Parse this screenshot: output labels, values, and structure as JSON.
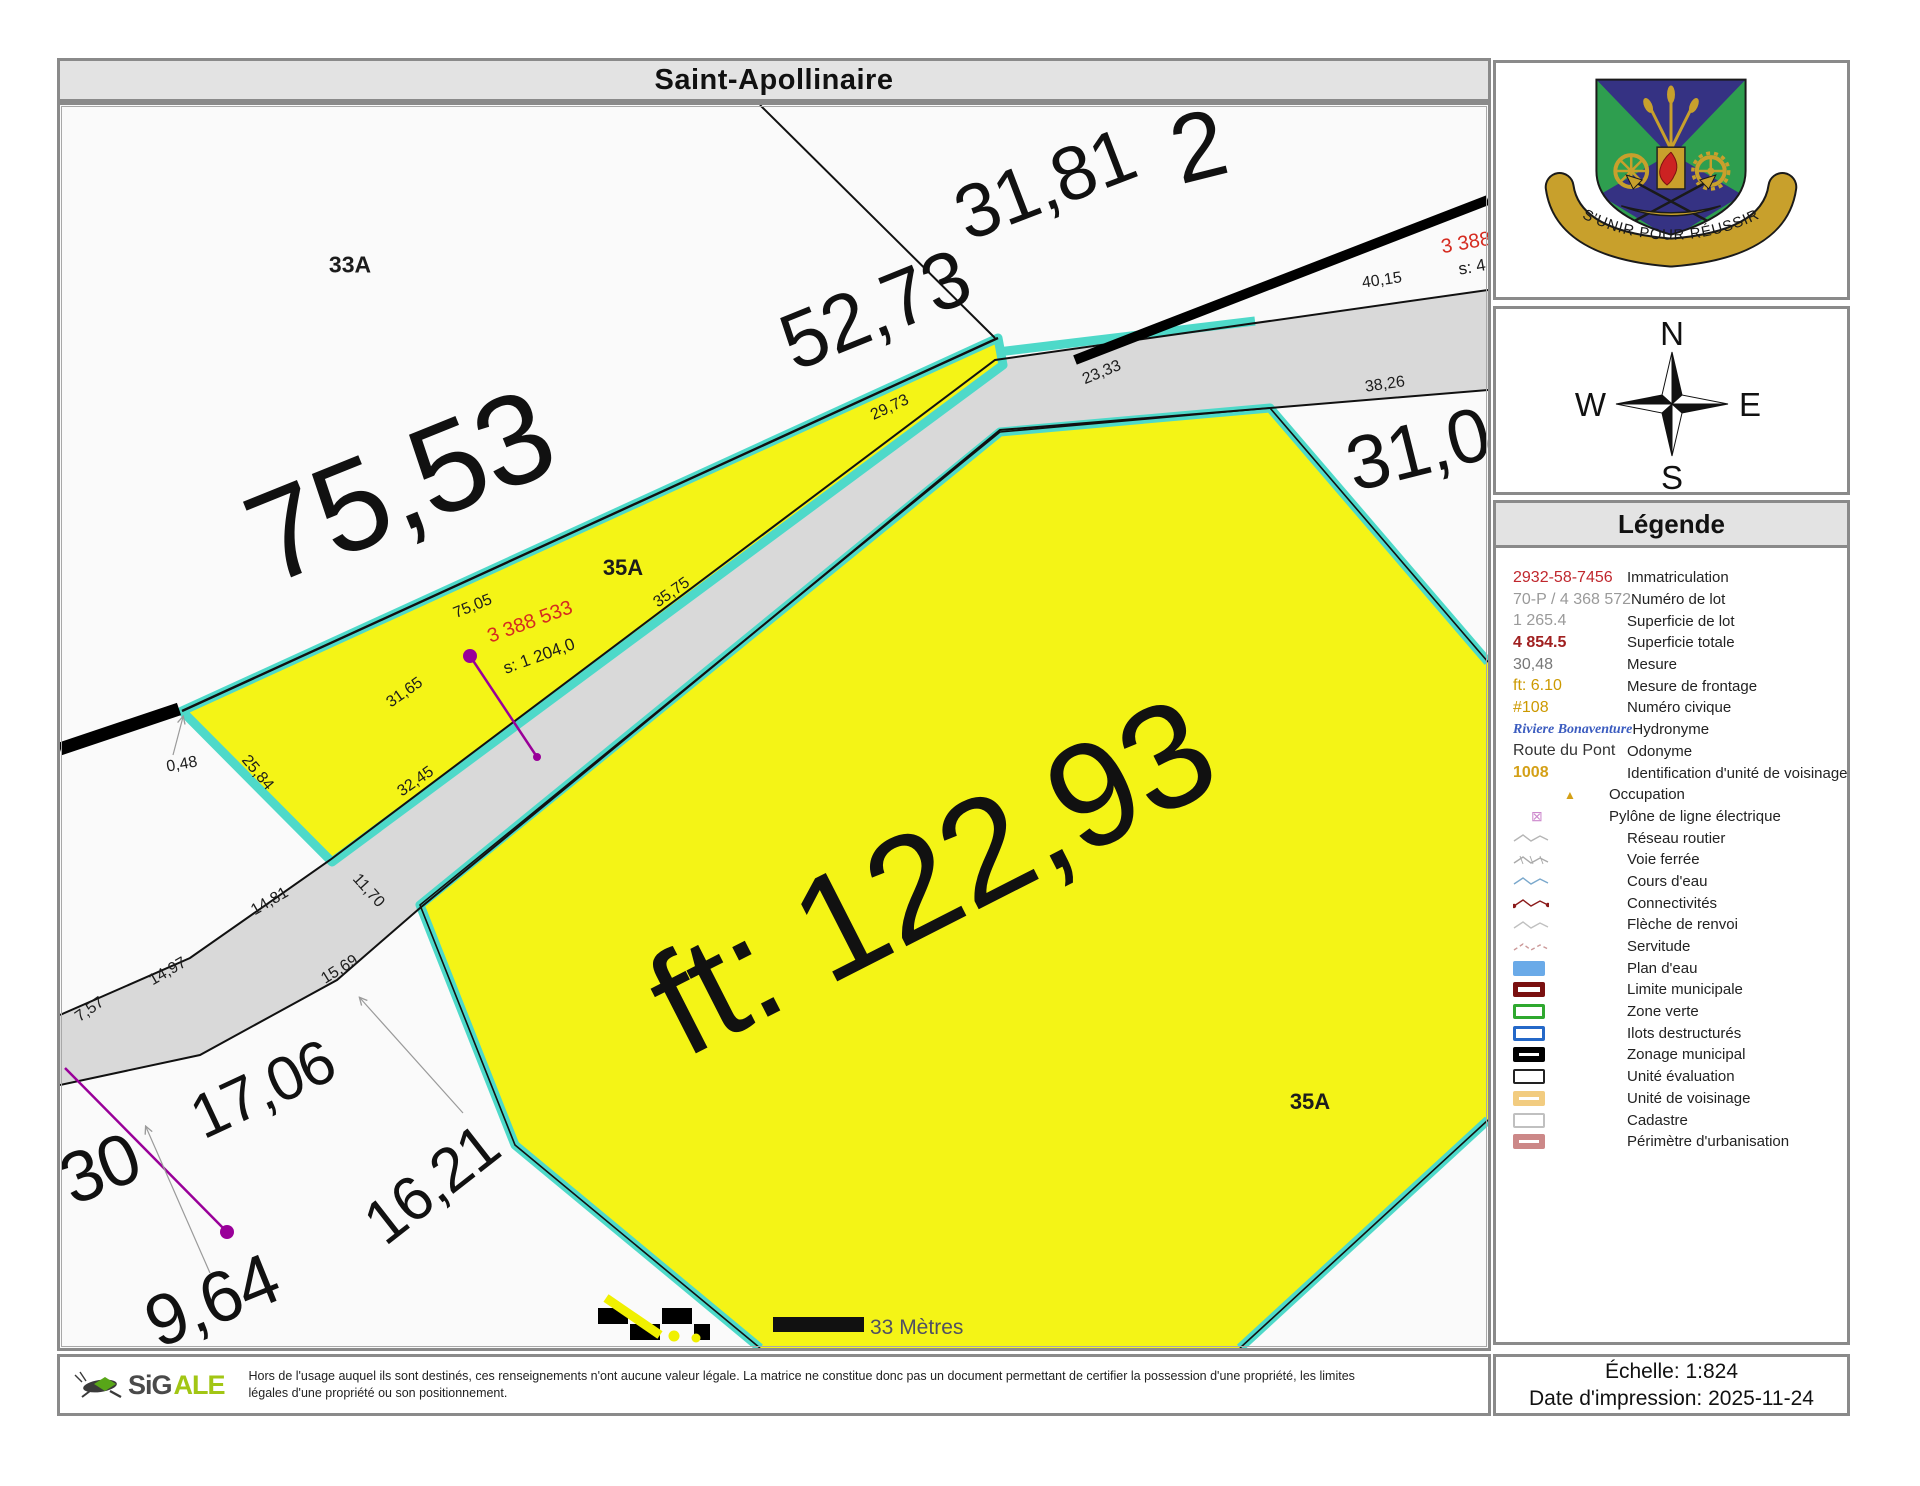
{
  "title": "Saint-Apollinaire",
  "colors": {
    "parcel_yellow": "#f4f416",
    "water_cyan": "#4ed9c9",
    "road_gray": "#d9d9d9",
    "map_bg": "#fafafa",
    "panel_border": "#8a8a8a",
    "header_bg": "#e3e3e3",
    "label_red": "#d52b20",
    "purple": "#990099"
  },
  "map": {
    "scale_bar_label": "33 Mètres",
    "labels": [
      {
        "text": "75,53",
        "x": 340,
        "y": 382,
        "rot": -22,
        "size": 128
      },
      {
        "text": "52,73",
        "x": 815,
        "y": 205,
        "rot": -22,
        "size": 80
      },
      {
        "text": "31,81",
        "x": 985,
        "y": 80,
        "rot": -21,
        "size": 76
      },
      {
        "text": "2",
        "x": 1138,
        "y": 42,
        "rot": -14,
        "size": 96
      },
      {
        "text": "31,0",
        "x": 1358,
        "y": 345,
        "rot": -14,
        "size": 76
      },
      {
        "text": "ft: 122,93",
        "x": 872,
        "y": 772,
        "rot": -27,
        "size": 148
      },
      {
        "text": "17,06",
        "x": 203,
        "y": 985,
        "rot": -25,
        "size": 62
      },
      {
        "text": "16,21",
        "x": 372,
        "y": 1080,
        "rot": -38,
        "size": 62
      },
      {
        "text": "9,64",
        "x": 152,
        "y": 1196,
        "rot": -22,
        "size": 72
      },
      {
        "text": "30",
        "x": 40,
        "y": 1064,
        "rot": -22,
        "size": 72
      },
      {
        "text": "33A",
        "x": 290,
        "y": 160,
        "rot": 0,
        "size": 23,
        "weight": 700
      },
      {
        "text": "35A",
        "x": 563,
        "y": 463,
        "rot": 0,
        "size": 22,
        "weight": 700
      },
      {
        "text": "35A",
        "x": 1250,
        "y": 997,
        "rot": 0,
        "size": 22,
        "weight": 700
      },
      {
        "text": "40,15",
        "x": 1322,
        "y": 176,
        "rot": -8,
        "size": 16
      },
      {
        "text": "38,26",
        "x": 1325,
        "y": 280,
        "rot": -8,
        "size": 16
      },
      {
        "text": "23,33",
        "x": 1042,
        "y": 268,
        "rot": -22,
        "size": 16
      },
      {
        "text": "29,73",
        "x": 830,
        "y": 303,
        "rot": -25,
        "size": 16
      },
      {
        "text": "35,75",
        "x": 612,
        "y": 488,
        "rot": -35,
        "size": 16
      },
      {
        "text": "75,05",
        "x": 413,
        "y": 502,
        "rot": -22,
        "size": 16
      },
      {
        "text": "3 388 533",
        "x": 470,
        "y": 517,
        "rot": -20,
        "size": 20,
        "color": "red"
      },
      {
        "text": "s: 1 204,0",
        "x": 479,
        "y": 551,
        "rot": -20,
        "size": 17
      },
      {
        "text": "3 388",
        "x": 1406,
        "y": 138,
        "rot": -10,
        "size": 20,
        "color": "red"
      },
      {
        "text": "s: 4",
        "x": 1412,
        "y": 162,
        "rot": -10,
        "size": 17
      },
      {
        "text": "0,48",
        "x": 122,
        "y": 660,
        "rot": -10,
        "size": 16
      },
      {
        "text": "25,84",
        "x": 197,
        "y": 668,
        "rot": 50,
        "size": 16
      },
      {
        "text": "32,45",
        "x": 356,
        "y": 677,
        "rot": -35,
        "size": 16
      },
      {
        "text": "31,65",
        "x": 345,
        "y": 588,
        "rot": -35,
        "size": 16
      },
      {
        "text": "11,70",
        "x": 308,
        "y": 786,
        "rot": 48,
        "size": 16
      },
      {
        "text": "14,81",
        "x": 210,
        "y": 797,
        "rot": -30,
        "size": 16
      },
      {
        "text": "14,97",
        "x": 108,
        "y": 867,
        "rot": -30,
        "size": 16
      },
      {
        "text": "15,69",
        "x": 280,
        "y": 865,
        "rot": -32,
        "size": 16
      },
      {
        "text": "7,57",
        "x": 30,
        "y": 905,
        "rot": -35,
        "size": 16
      }
    ]
  },
  "sidebar": {
    "crest_motto": "S'UNIR POUR RÉUSSIR",
    "compass": {
      "n": "N",
      "e": "E",
      "s": "S",
      "w": "W"
    },
    "legend": {
      "title": "Légende",
      "items": [
        {
          "symbol": "text",
          "sample": "2932-58-7456",
          "color": "#c0272d",
          "label": "Immatriculation"
        },
        {
          "symbol": "text",
          "sample": "70-P / 4 368 572",
          "color": "#9a9a9a",
          "label": "Numéro de lot"
        },
        {
          "symbol": "text",
          "sample": "1 265.4",
          "color": "#9a9a9a",
          "label": "Superficie de lot"
        },
        {
          "symbol": "text-bold",
          "sample": "4 854.5",
          "color": "#a02020",
          "label": "Superficie totale"
        },
        {
          "symbol": "text",
          "sample": "30,48",
          "color": "#777777",
          "label": "Mesure"
        },
        {
          "symbol": "text",
          "sample": "ft: 6.10",
          "color": "#cc9900",
          "label": "Mesure de frontage"
        },
        {
          "symbol": "text",
          "sample": "#108",
          "color": "#cc9900",
          "label": "Numéro civique"
        },
        {
          "symbol": "text-italic",
          "sample": "Riviere Bonaventure",
          "color": "#3a5bbf",
          "label": "Hydronyme"
        },
        {
          "symbol": "text",
          "sample": "Route du Pont",
          "color": "#333333",
          "label": "Odonyme"
        },
        {
          "symbol": "text-bold",
          "sample": "1008",
          "color": "#d4a017",
          "label": "Identification d'unité de voisinage"
        },
        {
          "symbol": "triangle",
          "color": "#d4a017",
          "label": "Occupation"
        },
        {
          "symbol": "pylon",
          "color": "#cc88cc",
          "label": "Pylône de ligne électrique"
        },
        {
          "symbol": "zigzag",
          "color": "#b5b5b5",
          "label": "Réseau routier"
        },
        {
          "symbol": "zigzag-ticks",
          "color": "#aaaaaa",
          "label": "Voie ferrée"
        },
        {
          "symbol": "zigzag",
          "color": "#7aa8cc",
          "label": "Cours d'eau"
        },
        {
          "symbol": "zigzag-dots",
          "color": "#8b1a1a",
          "label": "Connectivités"
        },
        {
          "symbol": "zigzag",
          "color": "#c0c0c0",
          "label": "Flèche de renvoi"
        },
        {
          "symbol": "zigzag-dash",
          "color": "#cc9999",
          "label": "Servitude"
        },
        {
          "symbol": "rect-fill",
          "color": "#6aaae8",
          "label": "Plan d'eau"
        },
        {
          "symbol": "rect",
          "color": "#7a1010",
          "bw": 5,
          "label": "Limite municipale"
        },
        {
          "symbol": "rect",
          "color": "#2fa82f",
          "bw": 3,
          "label": "Zone verte"
        },
        {
          "symbol": "rect",
          "color": "#2468c8",
          "bw": 3,
          "label": "Ilots destructurés"
        },
        {
          "symbol": "rect",
          "color": "#000000",
          "bw": 6,
          "label": "Zonage municipal"
        },
        {
          "symbol": "rect",
          "color": "#222222",
          "bw": 2,
          "label": "Unité évaluation"
        },
        {
          "symbol": "rect",
          "color": "#f2cc80",
          "bw": 6,
          "label": "Unité de voisinage"
        },
        {
          "symbol": "rect",
          "color": "#c0c0c0",
          "bw": 2,
          "label": "Cadastre"
        },
        {
          "symbol": "rect",
          "color": "#cc8888",
          "bw": 6,
          "label": "Périmètre d'urbanisation"
        }
      ]
    },
    "scale_text": "Échelle: 1:824",
    "date_text": "Date d'impression: 2025-11-24"
  },
  "footer": {
    "logo_text_dark": "SiG",
    "logo_text_green": "ALE",
    "disclaimer_line1": "Hors de l'usage auquel ils sont destinés, ces renseignements n'ont aucune valeur légale.  La matrice ne constitue donc pas un document permettant de certifier la possession d'une propriété, les limites",
    "disclaimer_line2": "légales d'une propriété ou son positionnement."
  }
}
